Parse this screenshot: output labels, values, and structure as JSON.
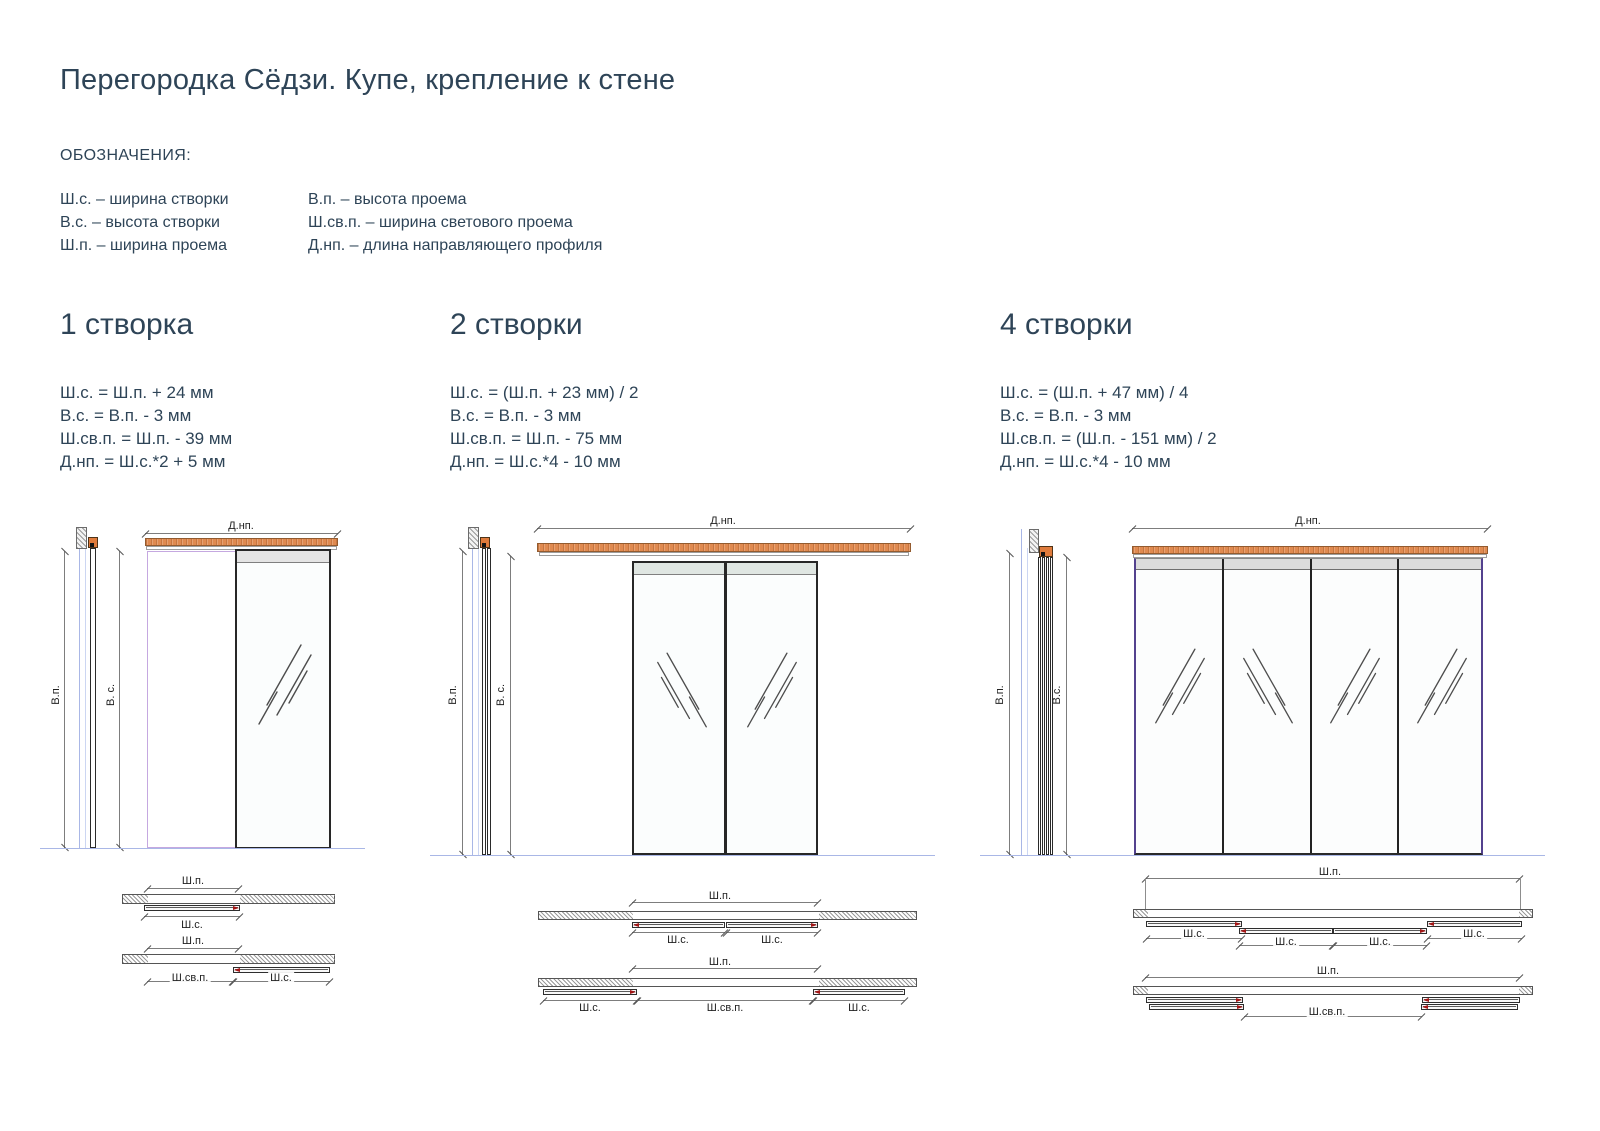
{
  "page": {
    "title": "Перегородка Сёдзи. Купе, крепление к стене"
  },
  "legend": {
    "heading": "ОБОЗНАЧЕНИЯ:",
    "col1": [
      "Ш.с. – ширина створки",
      "В.с. – высота створки",
      "Ш.п. – ширина проема"
    ],
    "col2": [
      "В.п. – высота проема",
      "Ш.св.п. – ширина светового проема",
      "Д.нп. – длина направляющего профиля"
    ]
  },
  "sections": [
    {
      "heading": "1 створка",
      "formulas": [
        "Ш.с. = Ш.п. + 24 мм",
        "В.с. = В.п. - 3 мм",
        "Ш.св.п. = Ш.п. - 39 мм",
        "Д.нп. = Ш.с.*2 + 5 мм"
      ],
      "labels": {
        "dnp": "Д.нп.",
        "vp": "В.п.",
        "vs": "В. с.",
        "shp": "Ш.п.",
        "shs": "Ш.с.",
        "shsvp": "Ш.св.п."
      }
    },
    {
      "heading": "2 створки",
      "formulas": [
        "Ш.с. = (Ш.п. + 23 мм) / 2",
        "В.с. = В.п. - 3 мм",
        "Ш.св.п. = Ш.п. - 75 мм",
        "Д.нп. = Ш.с.*4 - 10 мм"
      ],
      "labels": {
        "dnp": "Д.нп.",
        "vp": "В.п.",
        "vs": "В. с.",
        "shp": "Ш.п.",
        "shs": "Ш.с.",
        "shsvp": "Ш.св.п."
      }
    },
    {
      "heading": "4 створки",
      "formulas": [
        "Ш.с. = (Ш.п. + 47 мм) / 4",
        "В.с. = В.п. - 3 мм",
        "Ш.св.п. = (Ш.п. - 151 мм) / 2",
        "Д.нп. = Ш.с.*4 - 10 мм"
      ],
      "labels": {
        "dnp": "Д.нп.",
        "vp": "В.п.",
        "vs": "В.с.",
        "shp": "Ш.п.",
        "shs": "Ш.с.",
        "shsvp": "Ш.св.п."
      }
    }
  ],
  "colors": {
    "text": "#2e4457",
    "track_orange": "#e08a50",
    "opening_outline": "#c5a8e0",
    "baseline_blue": "#a9b7e6",
    "marker_red": "#a31515"
  }
}
